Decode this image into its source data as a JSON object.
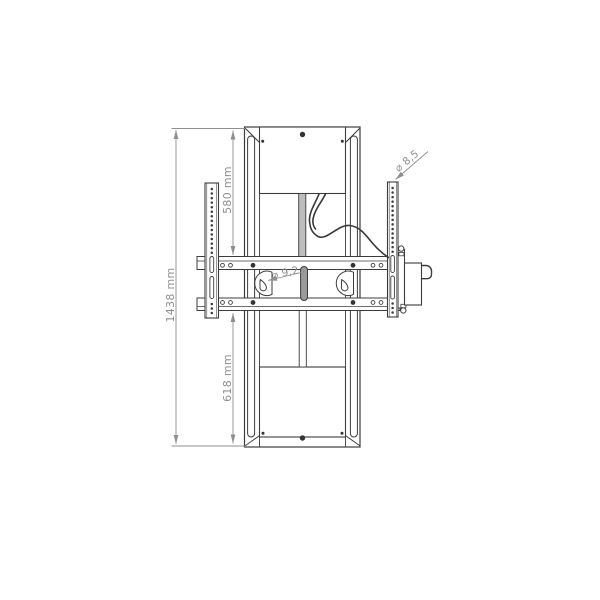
{
  "drawing": {
    "type": "technical-dimension-drawing",
    "subject": "motorised TV lift column with VESA mounting rails, front view",
    "labels": {
      "overall_height": "1438 mm",
      "upper_section_height": "580 mm",
      "lower_section_height": "618 mm",
      "rail_hole_diameter": "⌀ 8,5",
      "keyhole_slot_diameter": "⌀ 9,2"
    },
    "colors": {
      "outline": "#3c3c3c",
      "dimension": "#8f8f8f",
      "inner_tube_fill": "#9a9a9a",
      "upper_tube_fill": "#bdbdbd",
      "background": "#ffffff"
    }
  }
}
